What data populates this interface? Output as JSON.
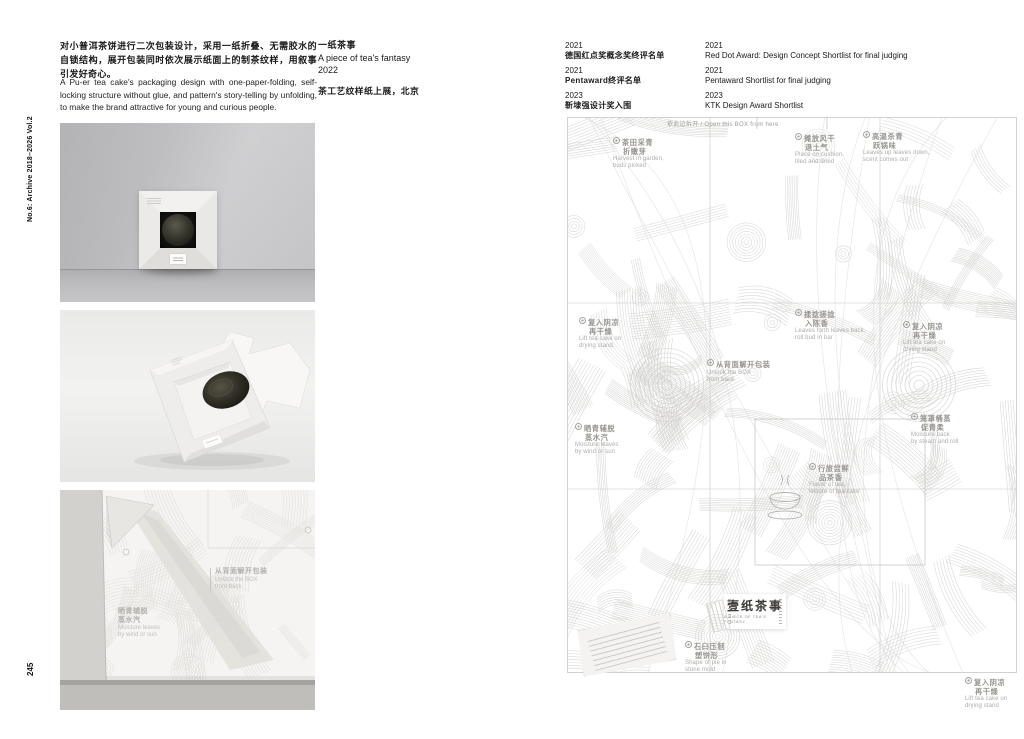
{
  "page": {
    "spine_label": "No.6: Archive 2018–2026 Vol.2",
    "page_number": "245"
  },
  "intro": {
    "zh": "对小普洱茶饼进行二次包装设计，采用一纸折叠、无需胶水的自锁结构，展开包装同时依次展示纸面上的制茶纹样，用叙事引发好奇心。",
    "en": "A Pu-er tea cake's packaging design with one-paper-folding, self-locking structure without glue, and pattern's story-telling by unfolding, to make the brand attractive for young and curious people."
  },
  "project": {
    "title_zh": "一纸茶事",
    "title_en": "A piece of tea's fantasy",
    "year": "2022",
    "exhibition": "茶工艺纹样纸上展，北京"
  },
  "awards": {
    "zh": [
      {
        "year": "2021",
        "name": "德国红点奖概念奖终评名单"
      },
      {
        "year": "2021",
        "name": "Pentaward终评名单"
      },
      {
        "year": "2023",
        "name": "靳埭强设计奖入围"
      }
    ],
    "en": [
      {
        "year": "2021",
        "name": "Red Dot Award: Design Concept Shortlist for final judging"
      },
      {
        "year": "2021",
        "name": "Pentaward Shortlist for final judging"
      },
      {
        "year": "2023",
        "name": "KTK Design Award Shortlist"
      }
    ]
  },
  "photo3_annotations": [
    {
      "x": 150,
      "y": 78,
      "zh1": "从背面解开包装",
      "zh2": "",
      "en1": "Unlock the BOX",
      "en2": "from back",
      "lead": true
    },
    {
      "x": 58,
      "y": 118,
      "zh1": "晒青辅脱",
      "zh2": "蒸水汽",
      "en1": "Moisture leaves",
      "en2": "by wind or sun",
      "lead": false
    }
  ],
  "dieline": {
    "open_hint": "依此边拆开 / Open this BOX from here",
    "logo_zh": "壹纸茶事",
    "logo_en": "A PIECE OF TEA'S FANTASY",
    "annotations": [
      {
        "x": 46,
        "y": 20,
        "zh1": "茶田采青",
        "zh2": "折嫩芽",
        "en1": "Harvest in garden,",
        "en2": "buds picked"
      },
      {
        "x": 228,
        "y": 16,
        "zh1": "摊放风干",
        "zh2": "退土气",
        "en1": "Place on cushion,",
        "en2": "tiled and dried"
      },
      {
        "x": 296,
        "y": 14,
        "zh1": "高温杀青",
        "zh2": "跃锅味",
        "en1": "Leaves up leaves down,",
        "en2": "scent comes out"
      },
      {
        "x": 12,
        "y": 200,
        "zh1": "复入阴凉",
        "zh2": "再干燥",
        "en1": "Lift tea cake on",
        "en2": "drying stand."
      },
      {
        "x": 228,
        "y": 192,
        "zh1": "揉捻搓捻",
        "zh2": "入陈香",
        "en1": "Leaves forth leaves back,",
        "en2": "roll bud in bar"
      },
      {
        "x": 336,
        "y": 204,
        "zh1": "复入阴凉",
        "zh2": "再干燥",
        "en1": "Lift tea cake on",
        "en2": "drying stand"
      },
      {
        "x": 140,
        "y": 242,
        "zh1": "从背面解开包装",
        "zh2": "",
        "en1": "Unlock the BOX",
        "en2": "from back"
      },
      {
        "x": 8,
        "y": 306,
        "zh1": "晒青辅脱",
        "zh2": "蒸水汽",
        "en1": "Moisture leaves",
        "en2": "by wind or sun"
      },
      {
        "x": 344,
        "y": 296,
        "zh1": "笼罩桶蒸",
        "zh2": "促青柔",
        "en1": "Moisture back",
        "en2": "by steam and roll"
      },
      {
        "x": 242,
        "y": 346,
        "zh1": "行旅尝鲜",
        "zh2": "品茶香",
        "en1": "Flavor of tea,",
        "en2": "leisure of tea cake"
      },
      {
        "x": 118,
        "y": 524,
        "zh1": "石臼压制",
        "zh2": "塑饼形",
        "en1": "Shape of pie in",
        "en2": "stone mold"
      },
      {
        "x": 398,
        "y": 560,
        "zh1": "复入阴凉",
        "zh2": "再干燥",
        "en1": "Lift tea cake on",
        "en2": "drying stand"
      }
    ]
  }
}
